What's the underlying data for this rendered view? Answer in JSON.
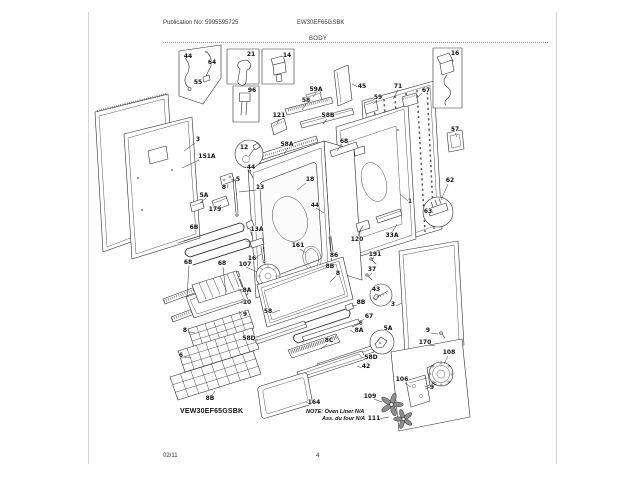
{
  "page": {
    "header": {
      "publication": "Publication No: 5995595725",
      "model": "EW30EF65GSBK",
      "section_title": "BODY"
    },
    "footer": {
      "date_code": "02/11",
      "page_number": "4"
    }
  },
  "diagram": {
    "model_label": "VEW30EF65GSBK",
    "note": {
      "line1": "NOTE: Oven Liner N/A",
      "line2": "Ass. du four N/A"
    },
    "callouts": [
      {
        "t": "44",
        "x": 188,
        "y": 58
      },
      {
        "t": "64",
        "x": 212,
        "y": 64
      },
      {
        "t": "55",
        "x": 198,
        "y": 84
      },
      {
        "t": "21",
        "x": 251,
        "y": 56
      },
      {
        "t": "14",
        "x": 287,
        "y": 57
      },
      {
        "t": "96",
        "x": 252,
        "y": 92
      },
      {
        "t": "16",
        "x": 455,
        "y": 55
      },
      {
        "t": "67",
        "x": 426,
        "y": 92
      },
      {
        "t": "71",
        "x": 398,
        "y": 88
      },
      {
        "t": "45",
        "x": 362,
        "y": 88
      },
      {
        "t": "59",
        "x": 378,
        "y": 99
      },
      {
        "t": "57",
        "x": 455,
        "y": 131
      },
      {
        "t": "59A",
        "x": 316,
        "y": 91
      },
      {
        "t": "58",
        "x": 306,
        "y": 102
      },
      {
        "t": "58B",
        "x": 328,
        "y": 117
      },
      {
        "t": "121",
        "x": 279,
        "y": 117
      },
      {
        "t": "3",
        "x": 198,
        "y": 141
      },
      {
        "t": "12",
        "x": 244,
        "y": 149
      },
      {
        "t": "44",
        "x": 251,
        "y": 169
      },
      {
        "t": "151A",
        "x": 207,
        "y": 158
      },
      {
        "t": "58A",
        "x": 287,
        "y": 146
      },
      {
        "t": "5",
        "x": 238,
        "y": 181
      },
      {
        "t": "8",
        "x": 224,
        "y": 189
      },
      {
        "t": "13",
        "x": 260,
        "y": 189
      },
      {
        "t": "5A",
        "x": 204,
        "y": 197
      },
      {
        "t": "179",
        "x": 215,
        "y": 211
      },
      {
        "t": "18",
        "x": 310,
        "y": 181
      },
      {
        "t": "44",
        "x": 315,
        "y": 207
      },
      {
        "t": "68",
        "x": 344,
        "y": 143
      },
      {
        "t": "6B",
        "x": 194,
        "y": 229
      },
      {
        "t": "13A",
        "x": 257,
        "y": 231
      },
      {
        "t": "16",
        "x": 252,
        "y": 260
      },
      {
        "t": "68",
        "x": 188,
        "y": 264
      },
      {
        "t": "68",
        "x": 222,
        "y": 265
      },
      {
        "t": "107",
        "x": 245,
        "y": 266
      },
      {
        "t": "161",
        "x": 298,
        "y": 247
      },
      {
        "t": "86",
        "x": 334,
        "y": 257
      },
      {
        "t": "8B",
        "x": 330,
        "y": 268
      },
      {
        "t": "8",
        "x": 338,
        "y": 275
      },
      {
        "t": "120",
        "x": 357,
        "y": 241
      },
      {
        "t": "191",
        "x": 375,
        "y": 256
      },
      {
        "t": "37",
        "x": 372,
        "y": 271
      },
      {
        "t": "33A",
        "x": 392,
        "y": 237
      },
      {
        "t": "1",
        "x": 410,
        "y": 203
      },
      {
        "t": "62",
        "x": 450,
        "y": 182
      },
      {
        "t": "63",
        "x": 428,
        "y": 213
      },
      {
        "t": "8A",
        "x": 247,
        "y": 292
      },
      {
        "t": "10",
        "x": 247,
        "y": 304
      },
      {
        "t": "9",
        "x": 245,
        "y": 316
      },
      {
        "t": "8",
        "x": 185,
        "y": 332
      },
      {
        "t": "6",
        "x": 181,
        "y": 357
      },
      {
        "t": "8B",
        "x": 210,
        "y": 400
      },
      {
        "t": "58",
        "x": 268,
        "y": 313
      },
      {
        "t": "8B",
        "x": 361,
        "y": 304
      },
      {
        "t": "43",
        "x": 376,
        "y": 291
      },
      {
        "t": "3",
        "x": 393,
        "y": 306
      },
      {
        "t": "67",
        "x": 369,
        "y": 318
      },
      {
        "t": "8A",
        "x": 359,
        "y": 332
      },
      {
        "t": "8C",
        "x": 329,
        "y": 342
      },
      {
        "t": "58D",
        "x": 249,
        "y": 340
      },
      {
        "t": "58D",
        "x": 371,
        "y": 359
      },
      {
        "t": "5A",
        "x": 388,
        "y": 330
      },
      {
        "t": "42",
        "x": 366,
        "y": 368
      },
      {
        "t": "164",
        "x": 314,
        "y": 404
      },
      {
        "t": "9",
        "x": 428,
        "y": 332
      },
      {
        "t": "170",
        "x": 425,
        "y": 344
      },
      {
        "t": "108",
        "x": 449,
        "y": 354
      },
      {
        "t": "106",
        "x": 402,
        "y": 381
      },
      {
        "t": "9",
        "x": 432,
        "y": 389
      },
      {
        "t": "109",
        "x": 370,
        "y": 398
      },
      {
        "t": "111",
        "x": 374,
        "y": 420
      }
    ]
  },
  "colors": {
    "paper": "#ffffff",
    "ink": "#2b2b2b",
    "label": "#101010"
  }
}
